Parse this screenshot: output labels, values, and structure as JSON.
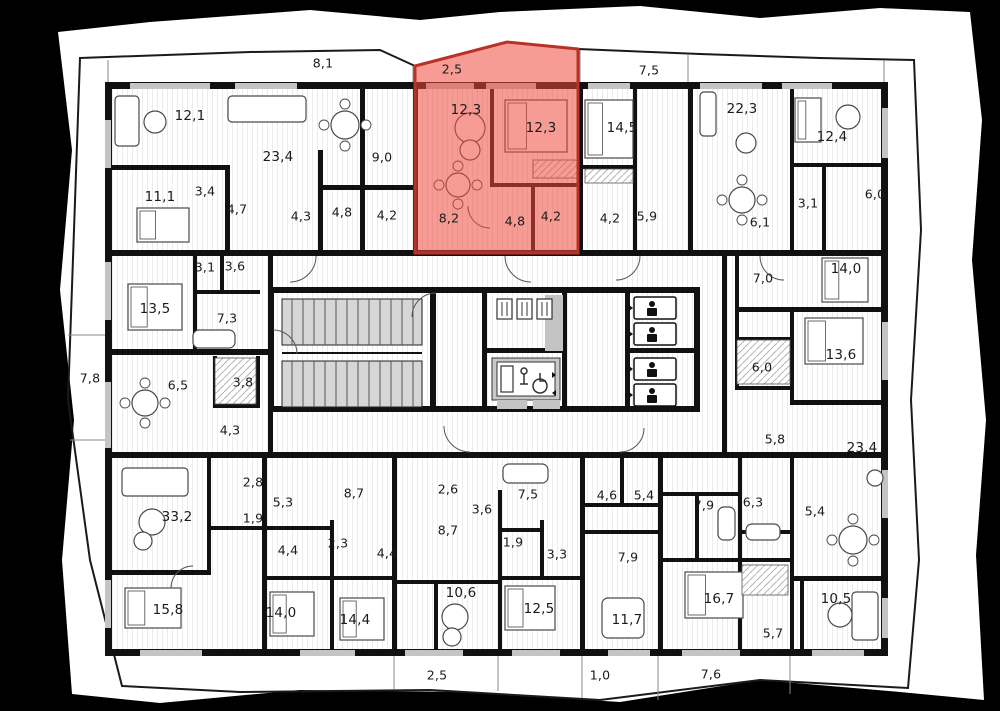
{
  "colors": {
    "background": "#000000",
    "paper": "#ffffff",
    "walls": "#111111",
    "window_gray": "#c4c4c4",
    "stair_gray": "#d6d6d6",
    "hatch_line": "#ececec",
    "label_color": "#1b1b1b",
    "highlight_fill": "#ee4b3c",
    "highlight_border": "#b93226"
  },
  "selected_unit": {
    "highlighted": true,
    "areas": [
      "2,5",
      "12,3",
      "12,3",
      "8,2",
      "4,8",
      "4,2"
    ]
  },
  "room_labels": [
    {
      "text": "8,1",
      "x": 323,
      "y": 63,
      "highlighted": false
    },
    {
      "text": "2,5",
      "x": 452,
      "y": 69,
      "highlighted": true
    },
    {
      "text": "7,5",
      "x": 649,
      "y": 70,
      "highlighted": false
    },
    {
      "text": "12,1",
      "x": 190,
      "y": 116,
      "highlighted": false
    },
    {
      "text": "23,4",
      "x": 278,
      "y": 157,
      "highlighted": false
    },
    {
      "text": "11,1",
      "x": 160,
      "y": 197,
      "highlighted": false
    },
    {
      "text": "3,4",
      "x": 205,
      "y": 191,
      "highlighted": false
    },
    {
      "text": "4,7",
      "x": 237,
      "y": 209,
      "highlighted": false
    },
    {
      "text": "4,3",
      "x": 301,
      "y": 216,
      "highlighted": false
    },
    {
      "text": "4,8",
      "x": 342,
      "y": 212,
      "highlighted": false
    },
    {
      "text": "9,0",
      "x": 382,
      "y": 157,
      "highlighted": false
    },
    {
      "text": "4,2",
      "x": 387,
      "y": 215,
      "highlighted": false
    },
    {
      "text": "12,3",
      "x": 466,
      "y": 110,
      "highlighted": true
    },
    {
      "text": "12,3",
      "x": 541,
      "y": 128,
      "highlighted": true
    },
    {
      "text": "8,2",
      "x": 449,
      "y": 218,
      "highlighted": true
    },
    {
      "text": "4,8",
      "x": 515,
      "y": 221,
      "highlighted": true
    },
    {
      "text": "4,2",
      "x": 551,
      "y": 216,
      "highlighted": true
    },
    {
      "text": "14,5",
      "x": 622,
      "y": 128,
      "highlighted": false
    },
    {
      "text": "4,2",
      "x": 610,
      "y": 218,
      "highlighted": false
    },
    {
      "text": "5,9",
      "x": 647,
      "y": 216,
      "highlighted": false
    },
    {
      "text": "22,3",
      "x": 742,
      "y": 109,
      "highlighted": false
    },
    {
      "text": "12,4",
      "x": 832,
      "y": 137,
      "highlighted": false
    },
    {
      "text": "3,1",
      "x": 808,
      "y": 203,
      "highlighted": false
    },
    {
      "text": "6,0",
      "x": 875,
      "y": 194,
      "highlighted": false
    },
    {
      "text": "6,1",
      "x": 760,
      "y": 222,
      "highlighted": false
    },
    {
      "text": "3,1",
      "x": 205,
      "y": 267,
      "highlighted": false
    },
    {
      "text": "3,6",
      "x": 235,
      "y": 266,
      "highlighted": false
    },
    {
      "text": "13,5",
      "x": 155,
      "y": 309,
      "highlighted": false
    },
    {
      "text": "7,3",
      "x": 227,
      "y": 318,
      "highlighted": false
    },
    {
      "text": "7,8",
      "x": 90,
      "y": 378,
      "highlighted": false
    },
    {
      "text": "6,5",
      "x": 178,
      "y": 385,
      "highlighted": false
    },
    {
      "text": "3,8",
      "x": 243,
      "y": 382,
      "highlighted": false
    },
    {
      "text": "4,3",
      "x": 230,
      "y": 430,
      "highlighted": false
    },
    {
      "text": "7,0",
      "x": 763,
      "y": 278,
      "highlighted": false
    },
    {
      "text": "14,0",
      "x": 846,
      "y": 269,
      "highlighted": false
    },
    {
      "text": "6,0",
      "x": 762,
      "y": 367,
      "highlighted": false
    },
    {
      "text": "13,6",
      "x": 841,
      "y": 355,
      "highlighted": false
    },
    {
      "text": "5,8",
      "x": 775,
      "y": 439,
      "highlighted": false
    },
    {
      "text": "23,4",
      "x": 862,
      "y": 448,
      "highlighted": false
    },
    {
      "text": "2,8",
      "x": 253,
      "y": 482,
      "highlighted": false
    },
    {
      "text": "5,3",
      "x": 283,
      "y": 502,
      "highlighted": false
    },
    {
      "text": "1,9",
      "x": 253,
      "y": 518,
      "highlighted": false
    },
    {
      "text": "8,7",
      "x": 354,
      "y": 493,
      "highlighted": false
    },
    {
      "text": "33,2",
      "x": 177,
      "y": 517,
      "highlighted": false
    },
    {
      "text": "2,3",
      "x": 338,
      "y": 543,
      "highlighted": false
    },
    {
      "text": "4,4",
      "x": 288,
      "y": 550,
      "highlighted": false
    },
    {
      "text": "15,8",
      "x": 168,
      "y": 610,
      "highlighted": false
    },
    {
      "text": "14,0",
      "x": 281,
      "y": 613,
      "highlighted": false
    },
    {
      "text": "14,4",
      "x": 355,
      "y": 620,
      "highlighted": false
    },
    {
      "text": "2,6",
      "x": 448,
      "y": 489,
      "highlighted": false
    },
    {
      "text": "7,5",
      "x": 528,
      "y": 494,
      "highlighted": false
    },
    {
      "text": "3,6",
      "x": 482,
      "y": 509,
      "highlighted": false
    },
    {
      "text": "8,7",
      "x": 448,
      "y": 530,
      "highlighted": false
    },
    {
      "text": "1,9",
      "x": 513,
      "y": 542,
      "highlighted": false
    },
    {
      "text": "3,3",
      "x": 557,
      "y": 554,
      "highlighted": false
    },
    {
      "text": "4,4",
      "x": 387,
      "y": 553,
      "highlighted": false
    },
    {
      "text": "10,6",
      "x": 461,
      "y": 593,
      "highlighted": false
    },
    {
      "text": "12,5",
      "x": 539,
      "y": 609,
      "highlighted": false
    },
    {
      "text": "4,6",
      "x": 607,
      "y": 495,
      "highlighted": false
    },
    {
      "text": "5,4",
      "x": 644,
      "y": 495,
      "highlighted": false
    },
    {
      "text": "7,9",
      "x": 628,
      "y": 557,
      "highlighted": false
    },
    {
      "text": "11,7",
      "x": 627,
      "y": 620,
      "highlighted": false
    },
    {
      "text": "7,9",
      "x": 704,
      "y": 505,
      "highlighted": false
    },
    {
      "text": "6,3",
      "x": 753,
      "y": 502,
      "highlighted": false
    },
    {
      "text": "5,4",
      "x": 815,
      "y": 511,
      "highlighted": false
    },
    {
      "text": "16,7",
      "x": 719,
      "y": 599,
      "highlighted": false
    },
    {
      "text": "10,5",
      "x": 836,
      "y": 599,
      "highlighted": false
    },
    {
      "text": "5,7",
      "x": 773,
      "y": 633,
      "highlighted": false
    },
    {
      "text": "2,5",
      "x": 437,
      "y": 675,
      "highlighted": false
    },
    {
      "text": "1,0",
      "x": 600,
      "y": 675,
      "highlighted": false
    },
    {
      "text": "7,6",
      "x": 711,
      "y": 674,
      "highlighted": false
    }
  ]
}
